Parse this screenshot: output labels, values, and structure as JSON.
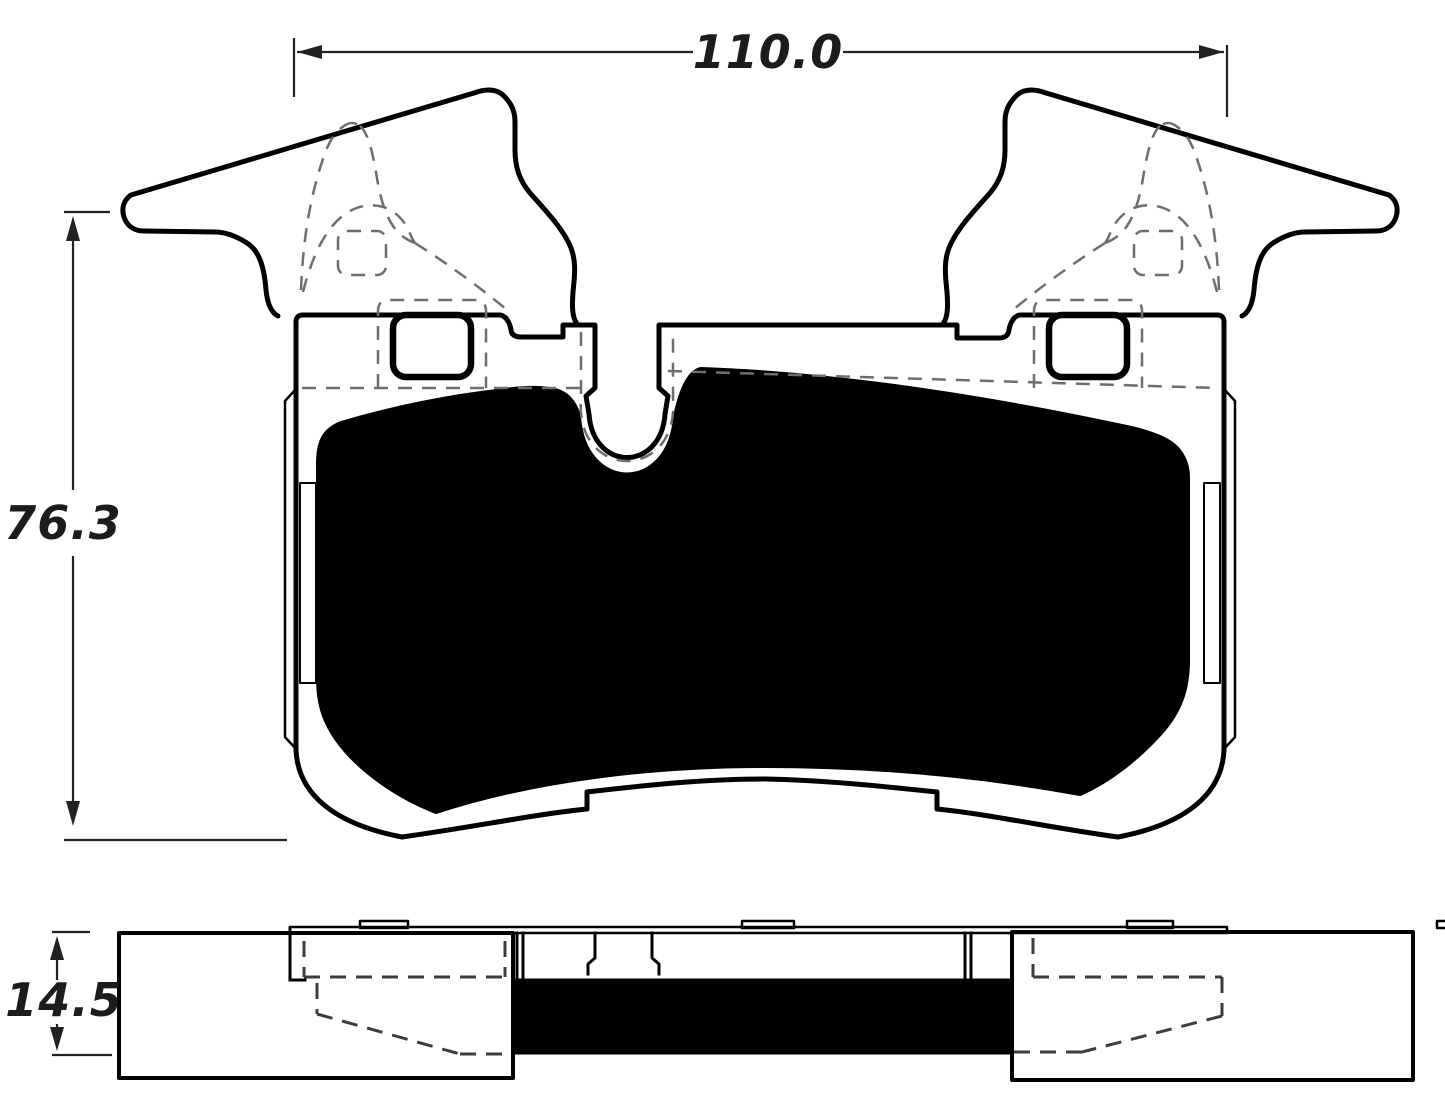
{
  "title": "Brake pad dimensional drawing",
  "dimensions": {
    "width_top": {
      "value": "110.0",
      "orientation": "horizontal"
    },
    "height_left": {
      "value": "76.3",
      "orientation": "vertical"
    },
    "thickness": {
      "value": "14.5",
      "orientation": "vertical"
    }
  },
  "views": {
    "front": {
      "features": [
        "left-mounting-ear",
        "right-mounting-ear",
        "backing-plate",
        "friction-material",
        "wear-sensor-slot",
        "abutment-hole-left",
        "abutment-hole-right",
        "shim-hidden-lines",
        "side-tab-left",
        "side-tab-right"
      ]
    },
    "side": {
      "features": [
        "left-end-block",
        "right-end-block",
        "backplate-edge-strip",
        "friction-strip",
        "hidden-chamfer-lines",
        "locator-tabs"
      ]
    }
  },
  "colors": {
    "line": "#000000",
    "friction": "#000000",
    "background": "#ffffff",
    "hidden_line": "#6e6e6e",
    "dimension_line": "#222222"
  }
}
